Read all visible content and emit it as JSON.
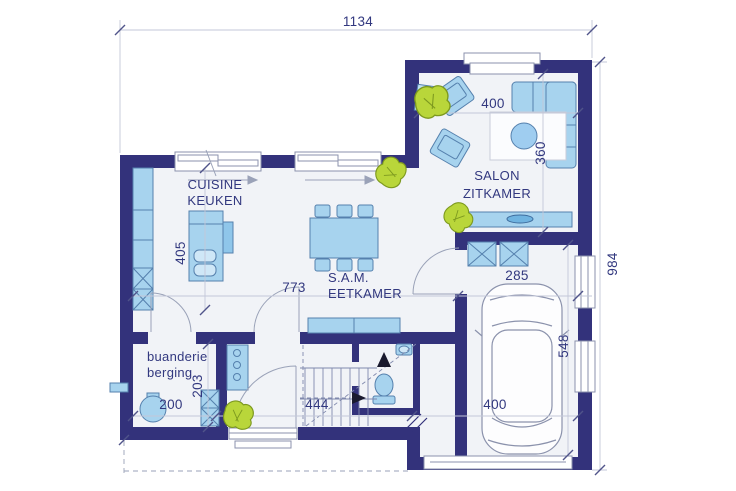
{
  "plan": {
    "type": "house-ground-floor-plan",
    "labels": {
      "kitchen_fr": "CUISINE",
      "kitchen_nl": "KEUKEN",
      "dining_fr": "S.A.M.",
      "dining_nl": "EETKAMER",
      "living_fr": "SALON",
      "living_nl": "ZITKAMER",
      "laundry_fr": "buanderie",
      "laundry_nl": "berging"
    },
    "dimensions_cm": {
      "overall_width": "1134",
      "overall_depth": "984",
      "living_width": "400",
      "living_depth": "360",
      "kitchen_counter": "405",
      "kitchen_dining_span": "773",
      "garage_clear": "285",
      "garage_depth": "548",
      "laundry_width": "200",
      "laundry_depth": "203",
      "hall_width": "444",
      "garage_width": "400"
    },
    "colors": {
      "wall": "#33327b",
      "floor": "#f1f3f7",
      "furniture_fill": "#a7d3ee",
      "furniture_stroke": "#5580ad",
      "plant_green": "#b9d63a",
      "label_text": "#32387f",
      "dim_line": "#c3c7d8"
    },
    "objects": [
      "corner-sofa",
      "armchair",
      "coffee-table",
      "rug",
      "sideboard",
      "dining-table-6-chairs",
      "kitchen-island",
      "kitchen-counter",
      "staircase",
      "toilet",
      "washbasin",
      "boiler",
      "car",
      "plant"
    ]
  }
}
